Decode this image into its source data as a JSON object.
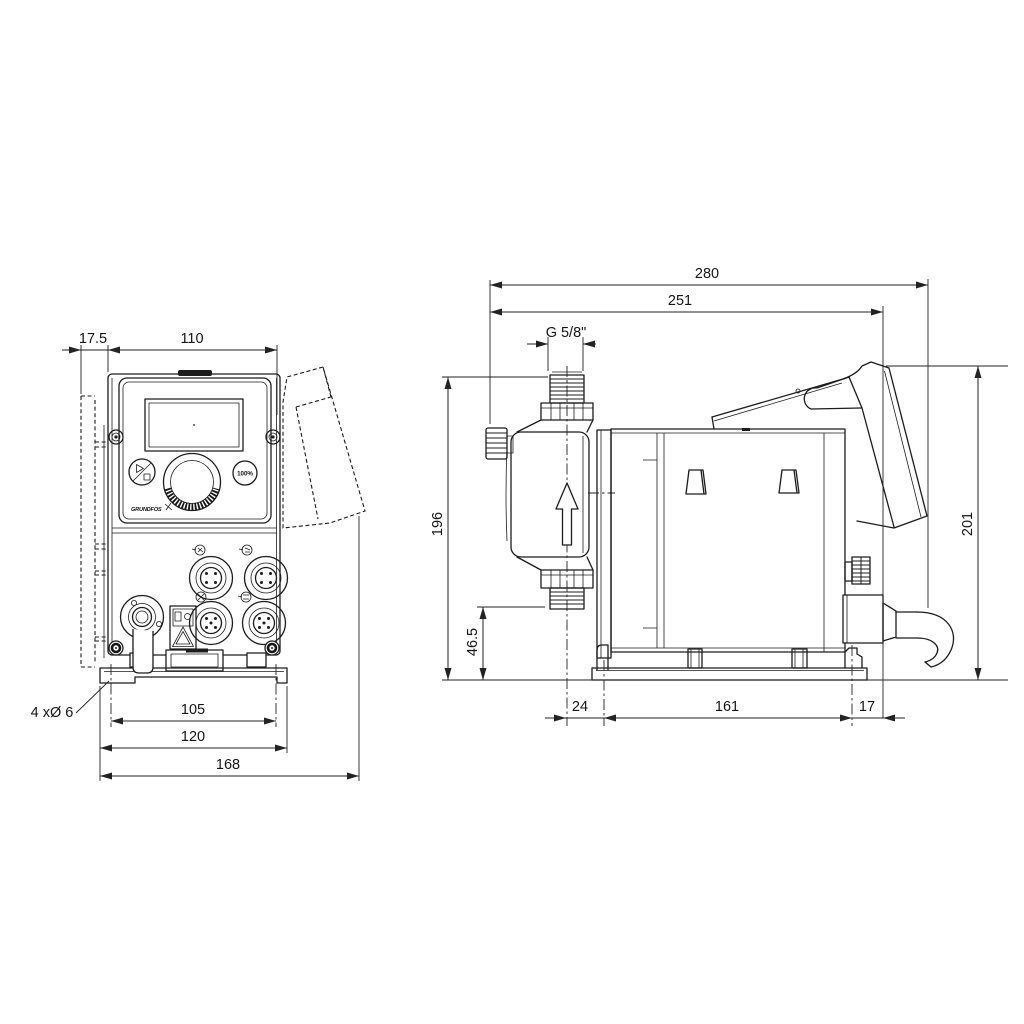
{
  "drawing": {
    "type": "technical-dimension-drawing",
    "subject": "Dosing pump outline drawing, front and side views",
    "background": "#ffffff",
    "line_color": "#1c1c1c",
    "front_view": {
      "dim_wallplate_offset": "17.5",
      "dim_panel_width": "110",
      "dim_hole_spacing": "105",
      "dim_plate_width": "120",
      "dim_overall_width": "168",
      "holes_label": "4 xØ 6",
      "percent_button_label": "100%",
      "logo_text": "GRUNDFOS"
    },
    "side_view": {
      "dim_overall_length": "280",
      "dim_length_to_gland": "251",
      "dim_connection_thread": "G 5/8\"",
      "dim_height_valve_top": "196",
      "dim_suction_valve_height": "46.5",
      "dim_front_overhang": "24",
      "dim_base_length": "161",
      "dim_rear_overhang": "17",
      "dim_overall_height": "201"
    }
  }
}
